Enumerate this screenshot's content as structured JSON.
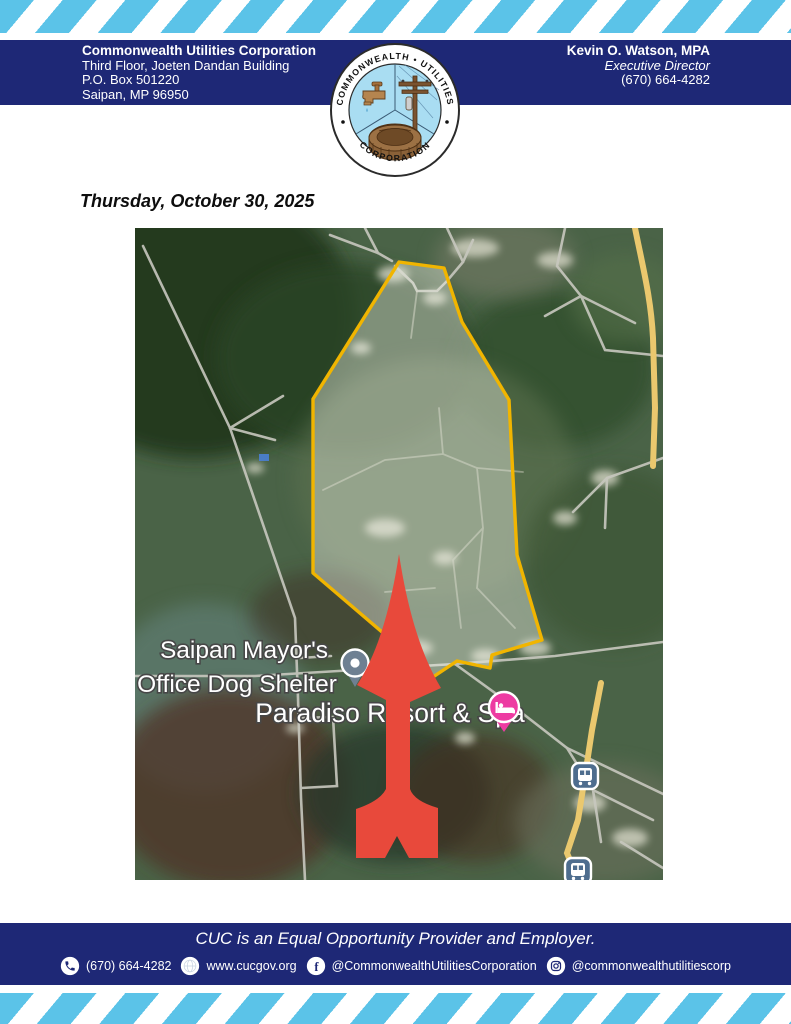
{
  "header": {
    "org_name": "Commonwealth Utilities Corporation",
    "address_line1": "Third Floor, Joeten Dandan Building",
    "address_line2": "P.O. Box 501220",
    "address_line3": "Saipan, MP 96950",
    "contact_name": "Kevin O. Watson, MPA",
    "contact_title": "Executive Director",
    "contact_phone": "(670) 664-4282",
    "logo": {
      "arc_top": "COMMONWEALTH • UTILITIES",
      "arc_bottom": "CORPORATION"
    }
  },
  "date_line": "Thursday, October 30, 2025",
  "map": {
    "labels": {
      "poi1_line1": "Saipan Mayor's",
      "poi1_line2": "Office Dog Shelter",
      "poi2": "Paradiso Resort & Spa"
    },
    "colors": {
      "boundary_yellow": "#F1B500",
      "arrow_red": "#E8493B",
      "hotel_pin_pink": "#ED3BA2",
      "transit_blue": "#4E6D8E"
    }
  },
  "footer": {
    "eoe_line": "CUC is an Equal Opportunity Provider and Employer.",
    "phone": "(670) 664-4282",
    "website": "www.cucgov.org",
    "facebook": "@CommonwealthUtilitiesCorporation",
    "instagram": "@commonwealthutilitiescorp"
  },
  "icons": {
    "facebook_glyph": "f"
  },
  "colors": {
    "navy": "#1E2876",
    "stripe_blue": "#5BC3E8"
  }
}
